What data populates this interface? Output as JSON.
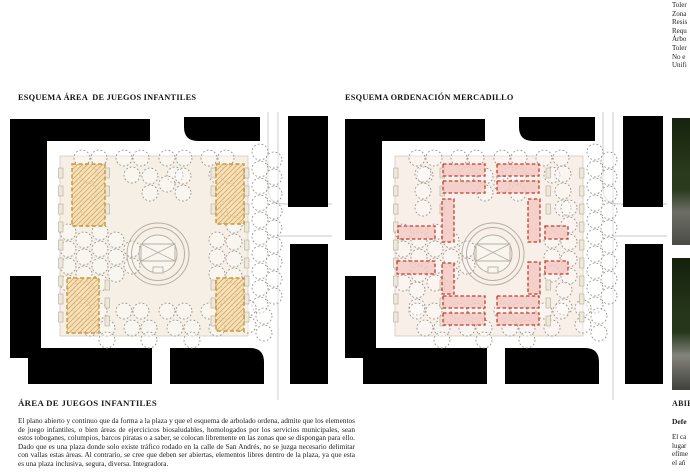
{
  "page": {
    "background": "#ffffff",
    "text_color": "#1c1c1c"
  },
  "top_right_list": {
    "lines": [
      "Toler",
      "Zona",
      "Resis",
      "Requ",
      "Árbo",
      "Toler",
      "No e",
      "Unifi"
    ]
  },
  "figures": [
    {
      "title": "ESQUEMA ÁREA  DE JUEGOS INFANTILES",
      "variant": "play",
      "plaza_fill": "#f5efe5"
    },
    {
      "title": "ESQUEMA ORDENACIÓN MERCADILLO",
      "variant": "market",
      "plaza_fill": "#f7efe8"
    }
  ],
  "article": {
    "heading": "ÁREA DE JUEGOS INFANTILES",
    "body": "El plano abierto y continuo que da forma a la plaza y que el esquema de arbolado ordena, admite que los elementos  de juego infantiles, o bien áreas de ejercicicos  biosaludables, homologados por los servicios municipales, sean estos toboganes, columpios, barcos piratas o a saber, se colocan libremente en las zonas que se dispongan para ello. Dado que es una plaza donde solo existe tráfico rodado en la calle de San Andrés, no se juzga necesario delimitar con vallas estas áreas. Al contrario, se cree que deben ser abiertas, elementos libres dentro de la plaza, ya que esta es una plaza inclusiva, segura, diversa. Integradora."
  },
  "right_column": {
    "heading_fragment": "ABIE",
    "subheading_fragment": "Defe",
    "body_fragments": [
      "El ca",
      "lugar",
      "efíme",
      "el añ"
    ]
  },
  "photos": [
    {
      "name": "site-photo-top",
      "palette": [
        "#16230e",
        "#2a3a1c",
        "#6d6e66",
        "#4a4b44"
      ]
    },
    {
      "name": "site-photo-bottom",
      "palette": [
        "#14210d",
        "#26361a",
        "#83847c",
        "#3f403a"
      ]
    }
  ],
  "diagram": {
    "canvas": {
      "w": 322,
      "h": 288
    },
    "colors": {
      "building": "#000000",
      "street": "#c9c9c9",
      "plaza_stroke": "#d6ccba",
      "tree": "#98948b",
      "play_fill": "#f3ddae",
      "play_hatch": "#dca75f",
      "play_stroke": "#c8963f",
      "stall_fill": "#f2cbc4",
      "stall_stroke": "#c23b2e",
      "fountain_stroke": "#b6afa2",
      "fountain_fill": "#f9f6ef",
      "bench_fill": "#eee8da",
      "bench_stroke": "#b3ab99"
    },
    "buildings": [
      "M0,7 H140 V29 H37 V128 H0 Z",
      "M174,5 H250 V29 H188 Q174,29 174,15 Z",
      "M278,4 H318 V95 H278 Z",
      "M280,132 H318 V272 H280 Z",
      "M0,164 H31 V246 H0 Z",
      "M18,236 H142 V272 H18 Z",
      "M160,236 H240 Q254,236 254,250 V272 H160 Z"
    ],
    "streets": [
      "M258,0 V76 Q258,92 274,92 L322,92",
      "M268,0 V288",
      "M268,124 H322"
    ],
    "plaza": {
      "x": 50,
      "y": 44,
      "w": 188,
      "h": 180
    },
    "tree_r": 8,
    "trees": [
      [
        72,
        46
      ],
      [
        89,
        46
      ],
      [
        114,
        46
      ],
      [
        131,
        46
      ],
      [
        157,
        46
      ],
      [
        174,
        46
      ],
      [
        199,
        46
      ],
      [
        216,
        46
      ],
      [
        80,
        63
      ],
      [
        122,
        63
      ],
      [
        165,
        63
      ],
      [
        207,
        63
      ],
      [
        140,
        64
      ],
      [
        173,
        64
      ],
      [
        157,
        72
      ],
      [
        140,
        81
      ],
      [
        173,
        81
      ],
      [
        78,
        62
      ],
      [
        78,
        79
      ],
      [
        78,
        96
      ],
      [
        218,
        62
      ],
      [
        218,
        79
      ],
      [
        218,
        96
      ],
      [
        58,
        120
      ],
      [
        58,
        137
      ],
      [
        58,
        154
      ],
      [
        58,
        171
      ],
      [
        74,
        128
      ],
      [
        74,
        145
      ],
      [
        74,
        162
      ],
      [
        90,
        120
      ],
      [
        90,
        137
      ],
      [
        90,
        154
      ],
      [
        90,
        171
      ],
      [
        106,
        128
      ],
      [
        106,
        145
      ],
      [
        106,
        162
      ],
      [
        122,
        137
      ],
      [
        122,
        154
      ],
      [
        207,
        128
      ],
      [
        207,
        145
      ],
      [
        207,
        162
      ],
      [
        224,
        96
      ],
      [
        224,
        113
      ],
      [
        224,
        130
      ],
      [
        224,
        147
      ],
      [
        224,
        164
      ],
      [
        72,
        178
      ],
      [
        72,
        195
      ],
      [
        219,
        178
      ],
      [
        219,
        195
      ],
      [
        72,
        199
      ],
      [
        89,
        199
      ],
      [
        114,
        199
      ],
      [
        131,
        199
      ],
      [
        157,
        199
      ],
      [
        174,
        199
      ],
      [
        199,
        199
      ],
      [
        216,
        199
      ],
      [
        80,
        216
      ],
      [
        97,
        216
      ],
      [
        122,
        216
      ],
      [
        139,
        216
      ],
      [
        165,
        216
      ],
      [
        182,
        216
      ],
      [
        207,
        216
      ],
      [
        97,
        228
      ],
      [
        139,
        228
      ],
      [
        182,
        228
      ],
      [
        250,
        40
      ],
      [
        250,
        57
      ],
      [
        250,
        74
      ],
      [
        250,
        91
      ],
      [
        250,
        108
      ],
      [
        250,
        125
      ],
      [
        250,
        142
      ],
      [
        250,
        159
      ],
      [
        250,
        176
      ],
      [
        250,
        193
      ],
      [
        264,
        48
      ],
      [
        264,
        65
      ],
      [
        264,
        82
      ],
      [
        264,
        99
      ],
      [
        264,
        116
      ],
      [
        264,
        133
      ],
      [
        264,
        150
      ],
      [
        264,
        167
      ],
      [
        264,
        184
      ],
      [
        238,
        196
      ],
      [
        254,
        204
      ],
      [
        238,
        213
      ],
      [
        254,
        221
      ]
    ],
    "benches": {
      "w": 4.5,
      "h": 10,
      "cols": [
        {
          "x": 48.5,
          "ys": [
            56,
            74,
            92,
            110,
            128,
            146,
            164,
            182,
            200
          ]
        },
        {
          "x": 234.5,
          "ys": [
            56,
            74,
            92,
            110,
            128,
            146,
            164,
            182,
            200
          ]
        },
        {
          "x": 95,
          "ys": [
            56,
            74,
            92,
            168,
            186,
            204
          ]
        },
        {
          "x": 201,
          "ys": [
            56,
            74,
            92,
            168,
            186,
            204
          ]
        }
      ]
    },
    "fountain": {
      "cx": 148,
      "cy": 142,
      "radii": [
        31,
        26.5,
        19
      ],
      "basin": {
        "x": 131,
        "y": 132,
        "w": 34,
        "h": 17
      },
      "pedestal": {
        "x": 143,
        "y": 155,
        "w": 10,
        "h": 6
      }
    },
    "play_areas": [
      {
        "x": 62,
        "y": 52,
        "w": 33,
        "h": 62
      },
      {
        "x": 206,
        "y": 52,
        "w": 28,
        "h": 60
      },
      {
        "x": 57,
        "y": 166,
        "w": 32,
        "h": 55
      },
      {
        "x": 206,
        "y": 166,
        "w": 28,
        "h": 53
      }
    ],
    "stalls": [
      {
        "x": 98,
        "y": 52,
        "w": 42,
        "h": 12
      },
      {
        "x": 98,
        "y": 69,
        "w": 42,
        "h": 12
      },
      {
        "x": 152,
        "y": 52,
        "w": 42,
        "h": 12
      },
      {
        "x": 152,
        "y": 69,
        "w": 42,
        "h": 12
      },
      {
        "x": 98,
        "y": 184,
        "w": 42,
        "h": 12
      },
      {
        "x": 98,
        "y": 201,
        "w": 42,
        "h": 12
      },
      {
        "x": 152,
        "y": 184,
        "w": 42,
        "h": 12
      },
      {
        "x": 152,
        "y": 201,
        "w": 42,
        "h": 12
      },
      {
        "x": 53,
        "y": 114,
        "w": 37,
        "h": 13
      },
      {
        "x": 52,
        "y": 149,
        "w": 38,
        "h": 13
      },
      {
        "x": 200,
        "y": 114,
        "w": 23,
        "h": 13
      },
      {
        "x": 200,
        "y": 149,
        "w": 23,
        "h": 13
      },
      {
        "x": 97,
        "y": 87,
        "w": 12,
        "h": 43
      },
      {
        "x": 183,
        "y": 87,
        "w": 12,
        "h": 43
      },
      {
        "x": 97,
        "y": 151,
        "w": 12,
        "h": 31
      },
      {
        "x": 183,
        "y": 150,
        "w": 12,
        "h": 32
      }
    ]
  }
}
